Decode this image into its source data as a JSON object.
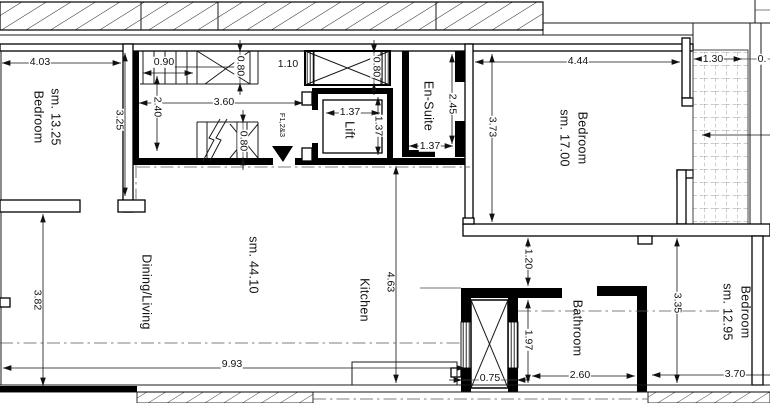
{
  "rooms": {
    "bedroom_left": {
      "label": "Bedroom",
      "area": "sm. 13.25"
    },
    "bedroom_right": {
      "label": "Bedroom",
      "area": "sm. 17.00"
    },
    "bedroom_bottom": {
      "label": "Bedroom",
      "area": "sm. 12.95"
    },
    "dining_living": {
      "label": "Dining/Living",
      "area": "sm. 44.10"
    },
    "kitchen": {
      "label": "Kitchen"
    },
    "bathroom": {
      "label": "Bathroom"
    },
    "ensuite": {
      "label": "En-Suite"
    },
    "lift": {
      "label": "Lift"
    }
  },
  "markers": {
    "flat_ref": "F1,2&3"
  },
  "dimensions": {
    "bedroom_left_width": "4.03",
    "bedroom_left_height": "3.25",
    "stair_width": "0.90",
    "stair_well_depth": "2.40",
    "core_width": "3.60",
    "stair_top_flight": "0.80",
    "landing": "1.10",
    "shaft_top": "0.80",
    "stair_bottom_flight": "0.80",
    "lift_width": "1.37",
    "lift_depth": "1.37",
    "ensuite_width": "1.37",
    "ensuite_height": "2.45",
    "bedroom_right_height": "3.73",
    "bedroom_right_width": "4.44",
    "balcony_width": "1.30",
    "balcony_cut": "0.",
    "living_height": "3.82",
    "living_width": "9.93",
    "kitchen_height": "4.63",
    "corridor": "1.20",
    "bathroom_depth": "1.97",
    "shaft_bottom_width": "0.75",
    "bathroom_width": "2.60",
    "bedroom_bottom_height": "3.35",
    "bedroom_bottom_width": "3.70"
  },
  "colors": {
    "line": "#000000",
    "dim": "#1a1a1a",
    "background": "#ffffff"
  }
}
